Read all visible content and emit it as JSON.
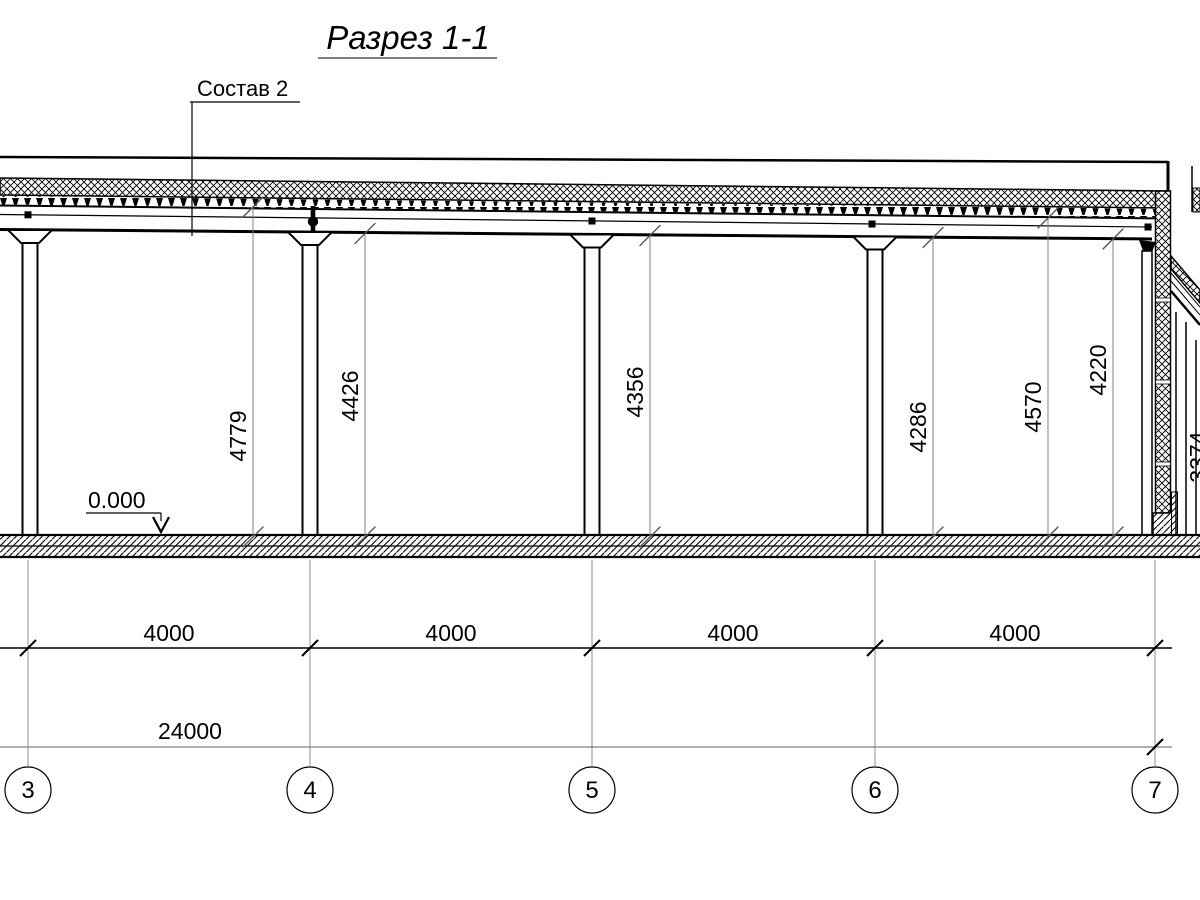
{
  "title": "Разрез 1-1",
  "callout": {
    "label": "Состав 2"
  },
  "level_mark": {
    "value": "0.000"
  },
  "dimensions": {
    "heights": [
      "4779",
      "4426",
      "4356",
      "4286",
      "4570",
      "4220"
    ],
    "annex_height": "3374",
    "bays": [
      "4000",
      "4000",
      "4000",
      "4000"
    ],
    "total": "24000"
  },
  "axes": [
    "3",
    "4",
    "5",
    "6",
    "7"
  ],
  "colors": {
    "line": "#000000",
    "secondary_line": "#808080",
    "background": "#ffffff"
  }
}
